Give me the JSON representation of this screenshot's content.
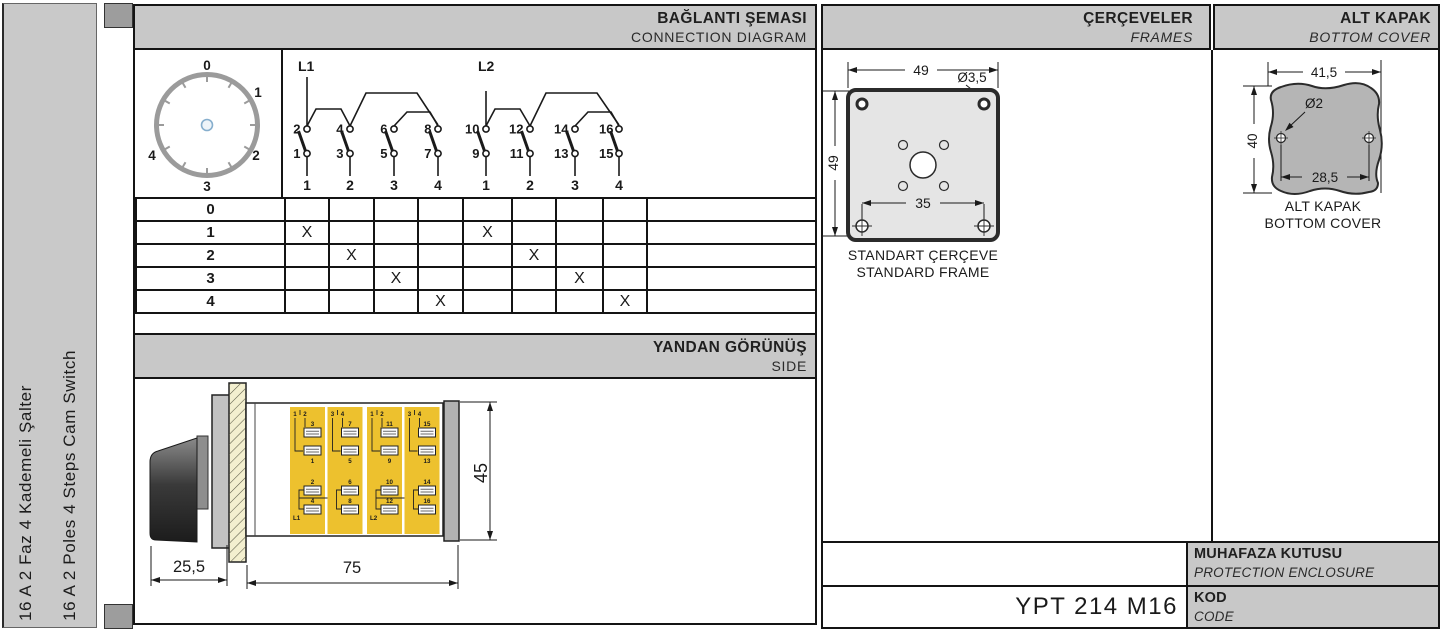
{
  "sidebar": {
    "line1": "16 A 2 Faz 4 Kademeli Şalter",
    "line2": "16 A 2 Poles 4 Steps Cam Switch"
  },
  "sections": {
    "connection": {
      "title_tr": "BAĞLANTI ŞEMASI",
      "title_en": "CONNECTION DIAGRAM"
    },
    "side": {
      "title_tr": "YANDAN GÖRÜNÜŞ",
      "title_en": "SIDE"
    },
    "frames": {
      "title_tr": "ÇERÇEVELER",
      "title_en": "FRAMES",
      "caption_tr": "STANDART ÇERÇEVE",
      "caption_en": "STANDARD FRAME"
    },
    "bottom_cover": {
      "title_tr": "ALT KAPAK",
      "title_en": "BOTTOM COVER",
      "caption_tr": "ALT KAPAK",
      "caption_en": "BOTTOM COVER"
    },
    "protection": {
      "title_tr": "MUHAFAZA KUTUSU",
      "title_en": "PROTECTION ENCLOSURE"
    },
    "code": {
      "title_tr": "KOD",
      "title_en": "CODE",
      "value": "YPT 214 M16"
    }
  },
  "dial": {
    "positions": [
      "0",
      "1",
      "2",
      "3",
      "4"
    ]
  },
  "connection_diagram": {
    "groups": [
      {
        "feed": "L1",
        "columns": [
          {
            "top": "2",
            "bottom": "1",
            "step": "1"
          },
          {
            "top": "4",
            "bottom": "3",
            "step": "2"
          },
          {
            "top": "6",
            "bottom": "5",
            "step": "3"
          },
          {
            "top": "8",
            "bottom": "7",
            "step": "4"
          }
        ]
      },
      {
        "feed": "L2",
        "columns": [
          {
            "top": "10",
            "bottom": "9",
            "step": "1"
          },
          {
            "top": "12",
            "bottom": "11",
            "step": "2"
          },
          {
            "top": "14",
            "bottom": "13",
            "step": "3"
          },
          {
            "top": "16",
            "bottom": "15",
            "step": "4"
          }
        ]
      }
    ]
  },
  "state_table": {
    "row_labels": [
      "0",
      "1",
      "2",
      "3",
      "4"
    ],
    "marks": [
      [
        "",
        "",
        "",
        "",
        "",
        "",
        "",
        ""
      ],
      [
        "X",
        "",
        "",
        "",
        "X",
        "",
        "",
        ""
      ],
      [
        "",
        "X",
        "",
        "",
        "",
        "X",
        "",
        ""
      ],
      [
        "",
        "",
        "X",
        "",
        "",
        "",
        "X",
        ""
      ],
      [
        "",
        "",
        "",
        "X",
        "",
        "",
        "",
        "X"
      ]
    ]
  },
  "side_view": {
    "dims": {
      "front": "25,5",
      "body": "75",
      "height": "45"
    },
    "modules": [
      {
        "pos_a": "1",
        "pos_b": "2",
        "upper": "3",
        "lower": "1",
        "bot_a": "2",
        "bot_b": "4",
        "feed": "L1"
      },
      {
        "pos_a": "3",
        "pos_b": "4",
        "upper": "7",
        "lower": "5",
        "bot_a": "6",
        "bot_b": "8",
        "feed": ""
      },
      {
        "pos_a": "1",
        "pos_b": "2",
        "upper": "11",
        "lower": "9",
        "bot_a": "10",
        "bot_b": "12",
        "feed": "L2"
      },
      {
        "pos_a": "3",
        "pos_b": "4",
        "upper": "15",
        "lower": "13",
        "bot_a": "14",
        "bot_b": "16",
        "feed": ""
      }
    ]
  },
  "frame_drawing": {
    "dims": {
      "width": "49",
      "height": "49",
      "hole_spacing": "35",
      "hole_dia": "Ø3,5"
    }
  },
  "cover_drawing": {
    "dims": {
      "width": "41,5",
      "height": "40",
      "hole_spacing": "28,5",
      "hole_dia": "Ø2"
    }
  },
  "colors": {
    "band_gray": "#c8c8c8",
    "sidebar_gray": "#c9c9c9",
    "module_yellow": "#edc12e",
    "hatch_cream": "#f3efcf",
    "terminal_label_blue": "#8ba4ba",
    "line_dark": "#141414"
  }
}
